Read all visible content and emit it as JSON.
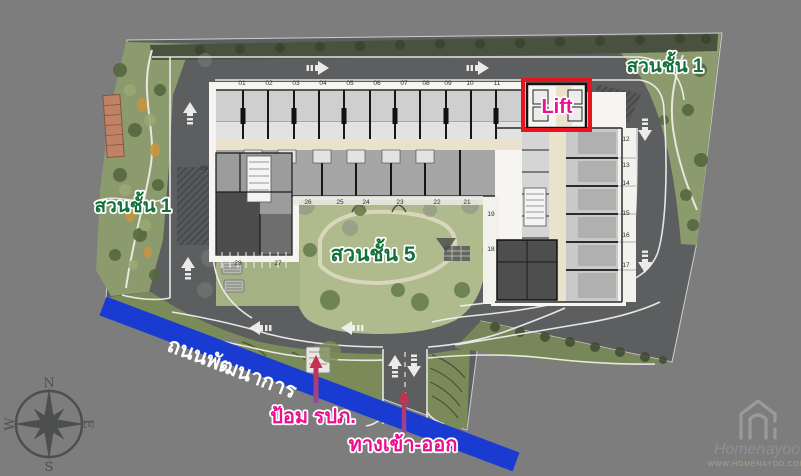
{
  "page": {
    "width": 801,
    "height": 476,
    "type": "condo-site-plan-annotated"
  },
  "labels": {
    "garden_floor1_right": "สวนชั้น 1",
    "garden_floor1_left": "สวนชั้น 1",
    "garden_floor5": "สวนชั้น 5",
    "lift": "Lift",
    "road_name": "ถนนพัฒนาการ",
    "guard_post": "ป้อม รปภ.",
    "entrance_exit": "ทางเข้า-ออก"
  },
  "compass": {
    "north": "N",
    "south": "S",
    "east": "E",
    "west": "W"
  },
  "watermark": {
    "brand": "Homenayoo",
    "url": "WWW.HOMENAYOO.COM"
  },
  "plan": {
    "parking_top": [
      "01",
      "02",
      "03",
      "04",
      "05",
      "06",
      "07",
      "08",
      "09",
      "10",
      "11"
    ],
    "units_right": [
      "12",
      "13",
      "14",
      "15",
      "16",
      "17"
    ],
    "units_inner": [
      "19",
      "18"
    ],
    "garden_row": [
      "26",
      "25",
      "24",
      "23",
      "22",
      "21"
    ],
    "stalls_lower": [
      "28",
      "27"
    ],
    "stall_upper": "29"
  },
  "colors": {
    "background_gray": "#7d7d7d",
    "asphalt": "#5c5e5f",
    "road_blue": "#1a3bd2",
    "accent_magenta": "#ec0f8f",
    "highlight_red": "#e8131f",
    "garden_label_green": "#15713c",
    "corridor_beige": "#eae2cc"
  }
}
